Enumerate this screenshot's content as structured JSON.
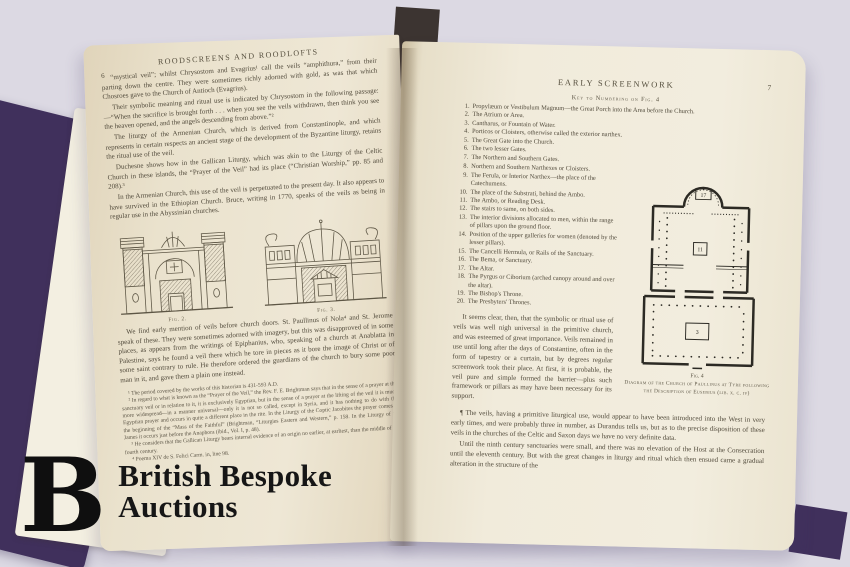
{
  "photo": {
    "background_color": "#dcd9e3",
    "cover_color": "#40305c",
    "page_color": "#f1ebdb",
    "ink_color": "#514a3b"
  },
  "watermark": {
    "logo_letter": "B",
    "line1": "British Bespoke",
    "line2": "Auctions"
  },
  "left_page": {
    "header": "ROODSCREENS AND ROODLOFTS",
    "page_number": "6",
    "paragraphs": [
      "“mystical veil”; whilst Chrysostom and Evagrius¹ call the veils “amphithura,” from their parting down the centre.  They were sometimes richly adorned with gold, as was that which Chosroes gave to the Church of Antioch (Evagrius).",
      "Their symbolic meaning and ritual use is indicated by Chrysostom in the following passage:—“When the sacrifice is brought forth . . . when you see the veils withdrawn, then think you see the heaven opened, and the angels descending from above.”²",
      "The liturgy of the Armenian Church, which is derived from Constantinople, and which represents in certain respects an ancient stage of the development of the Byzantine liturgy, retains the ritual use of the veil.",
      "Duchesne shows how in the Gallican Liturgy, which was akin to the Liturgy of the Celtic Church in these islands, the “Prayer of the Veil” had its place (“Christian Worship,” pp. 85 and 208).³",
      "In the Armenian Church, this use of the veil is perpetuated to the present day.  It also appears to have survived in the Ethiopian Church.  Bruce, writing in 1770, speaks of the veils as being in regular use in the Abyssinian churches."
    ],
    "figures": [
      {
        "caption": "Fig. 2."
      },
      {
        "caption": "Fig. 3."
      }
    ],
    "after_figures": "We find early mention of veils before church doors.  St. Paullinus of Nola⁴ and St. Jerome speak of these.  They were sometimes adorned with imagery, but this was disapproved of in some places, as appears from the writings of Epiphanius, who, speaking of a church at Anablatta in Palestine, says he found a veil there which he tore in pieces as it bore the image of Christ or of some saint contrary to rule.  He therefore ordered the guardians of the church to bury some poor man in it, and gave them a plain one instead.",
    "footnotes": [
      "¹ The period covered by the works of this historian is 431-593 A.D.",
      "² In regard to what is known as the “Prayer of the Veil,” the Rev. F. E. Brightman says that in the sense of a prayer at the sanctuary veil or in relation to it, it is exclusively Egyptian, but in the sense of a prayer at the lifting of the veil it is much more widespread—in a manner universal—only it is not so called, except in Syria, and it has nothing to do with the Egyptian prayer and occurs in quite a different place in the rite.  In the Liturgy of the Coptic Jacobites the prayer comes at the beginning of the “Mass of the Faithful” (Brightman, “Liturgies Eastern and Western,” p. 158.  In the Liturgy of St. James it occurs just before the Anaphora (ibid., Vol. I, p. 48).",
      "³ He considers that the Gallican Liturgy bears internal evidence of an origin no earlier, at earliest, than the middle of the fourth century.",
      "⁴ Poema XIV de S. Felici Carm. in, line 98."
    ]
  },
  "right_page": {
    "header": "EARLY SCREENWORK",
    "page_number": "7",
    "key_heading": "Key to Numbering on Fig. 4",
    "key_items": [
      {
        "n": "1.",
        "text": "Propylæum or Vestibulum Magnum—the Great Porch into the Area before the Church."
      },
      {
        "n": "2.",
        "text": "The Atrium or Area."
      },
      {
        "n": "3.",
        "text": "Cantharus, or Fountain of Water."
      },
      {
        "n": "4.",
        "text": "Porticos or Cloisters, otherwise called the exterior narthex."
      },
      {
        "n": "5.",
        "text": "The Great Gate into the Church."
      },
      {
        "n": "6.",
        "text": "The two lesser Gates."
      },
      {
        "n": "7.",
        "text": "The Northern and Southern Gates."
      },
      {
        "n": "8.",
        "text": "Northern and Southern Narthexes or Cloisters."
      },
      {
        "n": "9.",
        "text": "The Ferula, or Interior Narthex—the place of the Catechumens."
      },
      {
        "n": "10.",
        "text": "The place of the Substrati, behind the Ambo."
      },
      {
        "n": "11.",
        "text": "The Ambo, or Reading Desk."
      },
      {
        "n": "12.",
        "text": "The stairs to same, on both sides."
      },
      {
        "n": "13.",
        "text": "The interior divisions allocated to men, within the range of pillars upon the ground floor."
      },
      {
        "n": "14.",
        "text": "Position of the upper galleries for women (denoted by the lesser pillars)."
      },
      {
        "n": "15.",
        "text": "The Cancelli Hermula, or Rails of the Sanctuary."
      },
      {
        "n": "16.",
        "text": "The Bema, or Sanctuary."
      },
      {
        "n": "17.",
        "text": "The Altar."
      },
      {
        "n": "18.",
        "text": "The Pyrgus or Ciborium (arched canopy around and over the altar)."
      },
      {
        "n": "19.",
        "text": "The Bishop's Throne."
      },
      {
        "n": "20.",
        "text": "The Presbyters' Thrones."
      }
    ],
    "paragraph_symbolic": "It seems clear, then, that the symbolic or ritual use of veils was well nigh universal in the primitive church, and was esteemed of great importance.  Veils remained in use until long after the days of Constantine, often in the form of tapestry or a curtain, but by degrees regular screenwork took their place.  At first, it is probable, the veil pure and simple formed the barrier—plus such framework or pillars as may have been necessary for its support.",
    "figure": {
      "label": "Fig. 4",
      "caption": "Diagram of the Church of Paullinus at Tyre following the Description of Eusebius (lib. x. c. iv)",
      "numbers": {
        "altar": "17",
        "ambo": "11",
        "cantharus": "3"
      }
    },
    "bottom_paragraphs": [
      "¶  The veils, having a primitive liturgical use, would appear to have been introduced into the West in very early times, and were probably three in number, as Durandus tells us, but as to the precise disposition of these veils in the churches of the Celtic and Saxon days we have no very definite data.",
      "Until the ninth century sanctuaries were small, and there was no elevation of the Host at the Consecration until the eleventh century.  But with the great changes in liturgy and ritual which then ensued came a gradual alteration in the structure of the"
    ]
  }
}
